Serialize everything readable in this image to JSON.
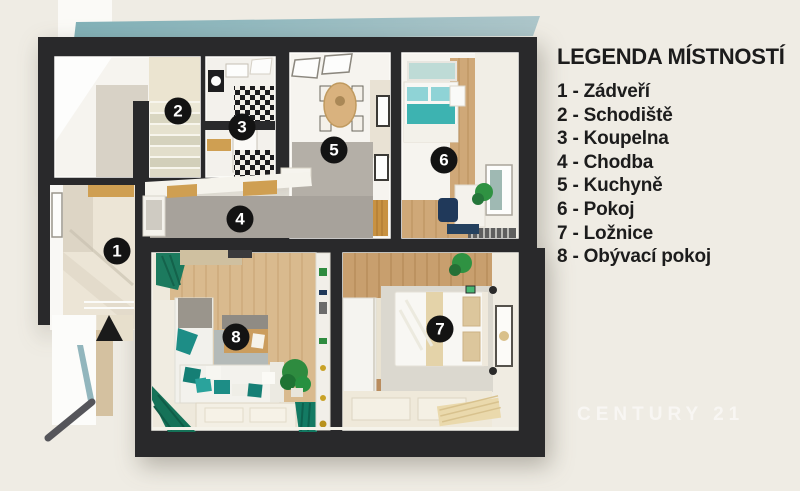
{
  "legend": {
    "title": "LEGENDA MÍSTNOSTÍ",
    "items": [
      "1 - Zádveří",
      "2 - Schodiště",
      "3 - Koupelna",
      "4 - Chodba",
      "5 - Kuchyně",
      "6 - Pokoj",
      "7 - Ložnice",
      "8 - Obývací pokoj"
    ]
  },
  "floorplan": {
    "badges": [
      "1",
      "2",
      "3",
      "4",
      "5",
      "6",
      "7",
      "8"
    ]
  },
  "watermark": {
    "text": "CENTURY 21"
  },
  "colors": {
    "background": "#efece4",
    "walls": "#29292b",
    "roof_band_teal": "#8fb9bf",
    "accent_teal": "#2aa39c",
    "curtain_green": "#1c7a5e",
    "wood_floor": "#d9ba8e",
    "corridor_gray": "#a7a29b"
  }
}
